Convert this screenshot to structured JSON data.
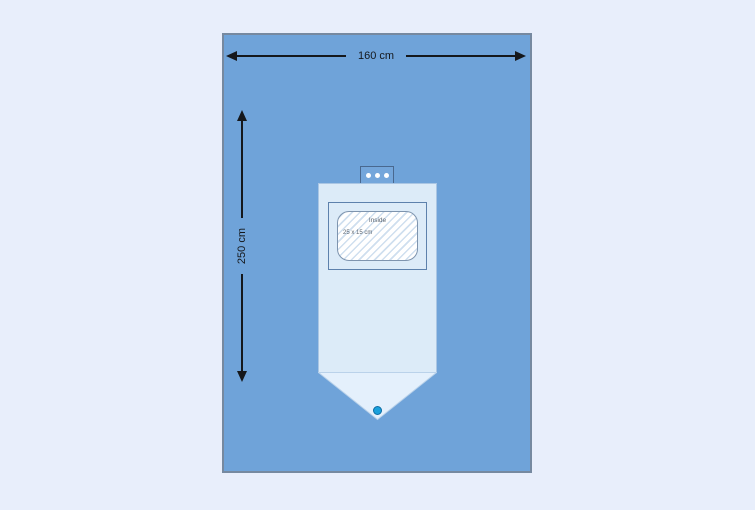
{
  "dimensions": {
    "width_label": "160 cm",
    "height_label": "250 cm"
  },
  "pouch_window": {
    "label": "Inside",
    "size_label": "25 x 15 cm"
  },
  "icons": {
    "tab_snap_dots": "three white circular snap dots on top tab",
    "pouch_port": "blue circular drainage port at pouch tip"
  },
  "colors": {
    "page_bg": "#e8eefb",
    "drape": "#6fa3d9",
    "drape_border": "#7689a0",
    "pouch": "#dcebf8",
    "pouch_light": "#e4f0fc",
    "pouch_border": "#aac6e4",
    "frame_border": "#5d81ac",
    "window_border": "#7e94ae",
    "hatch": "#cfdfef",
    "tab": "#74a6db",
    "tab_border": "#49688f",
    "arrow": "#15181c",
    "window_text": "#5a6470",
    "port": "#18a0dc",
    "port_border": "#0d6ca3"
  }
}
